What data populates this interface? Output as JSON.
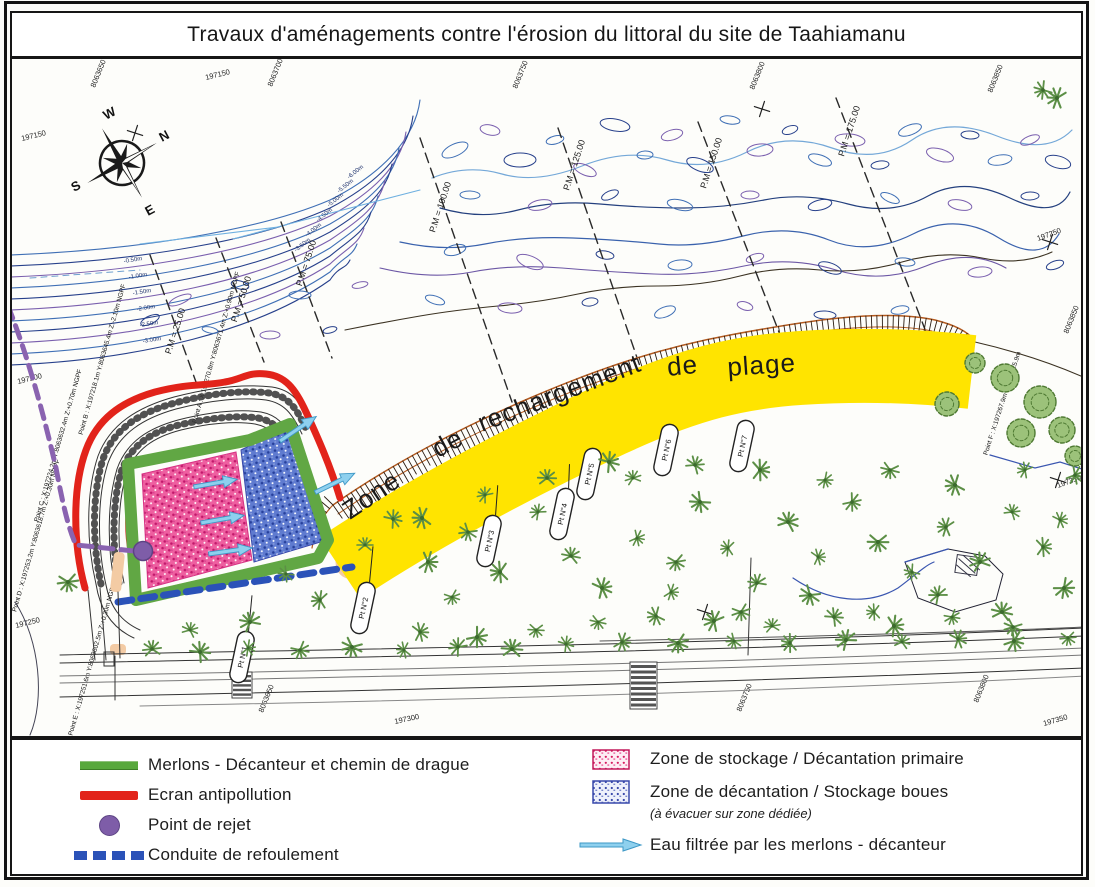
{
  "title": "Travaux d'aménagements contre l'érosion du littoral du site de Taahiamanu",
  "legend": {
    "left": [
      {
        "label": "Merlons - Décanteur et chemin de drague"
      },
      {
        "label": "Ecran antipollution"
      },
      {
        "label": "Point de rejet"
      },
      {
        "label": "Conduite de refoulement"
      }
    ],
    "right": [
      {
        "label": "Zone de stockage / Décantation primaire"
      },
      {
        "label": "Zone de décantation / Stockage boues",
        "note": "(à évacuer sur zone dédiée)"
      },
      {
        "label": "Eau filtrée par les merlons - décanteur"
      }
    ]
  },
  "map": {
    "band_words": [
      "Zone",
      "de",
      "rechargement",
      "de",
      "plage"
    ],
    "point_markers": [
      "Pt N°1",
      "Pt N°2",
      "Pt N°3",
      "Pt N°4",
      "Pt N°5",
      "Pt N°6",
      "Pt N°7"
    ],
    "pm_lines": [
      "P.M = 25.00",
      "P.M = 50.00",
      "P.M = 75.00",
      "P.M = 100.00",
      "P.M = 125.00",
      "P.M = 150.00",
      "P.M = 175.00"
    ],
    "grid_labels": [
      "8063650",
      "197150",
      "8063700",
      "8063750",
      "8063800",
      "8063850",
      "197150",
      "197200",
      "197250",
      "197250",
      "197350",
      "8063850",
      "8063650",
      "8063750",
      "8063800",
      "197300",
      "197350"
    ],
    "survey_points": [
      "Point A : X:197270.8m Y:8063671.4m Z:+0.90m NGPF",
      "Point B : X:197218.1m Y:8063645.4m Z:-2.10m NGPF",
      "Point C : X:197224.2m Y:8063632.4m Z:+0.70m NGPF",
      "Point D : X:197253.2m Y:8063618.7m Z:+0.30m NGPF",
      "Point E : X:197251.6m Y:8063602.5m Z:+0.30m NGPF",
      "Point F : X:197267.9m Y:8063525.9m"
    ],
    "depth_labels": [
      "-0.50m",
      "-1.00m",
      "-1.50m",
      "-2.00m",
      "-2.50m",
      "-3.00m",
      "-3.50m",
      "-4.00m",
      "-4.50m",
      "-5.00m",
      "-5.50m",
      "-6.00m"
    ],
    "compass": {
      "n": "N",
      "e": "E",
      "s": "S",
      "w": "W"
    }
  },
  "colors": {
    "recharge_band": "#ffe400",
    "storage_zone_pink": "#ee5fa0",
    "decantation_zone_blue": "#5f7bd0",
    "merlon_green": "#61a744",
    "ecran_red": "#e2231a",
    "rejet_purple": "#7e5da8",
    "conduite_blue": "#2b52b8",
    "filtered_water_arrow": "#8ed0ee",
    "contour_blue": "#3f6fb5",
    "beach_crest_orange": "#b35a1f"
  }
}
